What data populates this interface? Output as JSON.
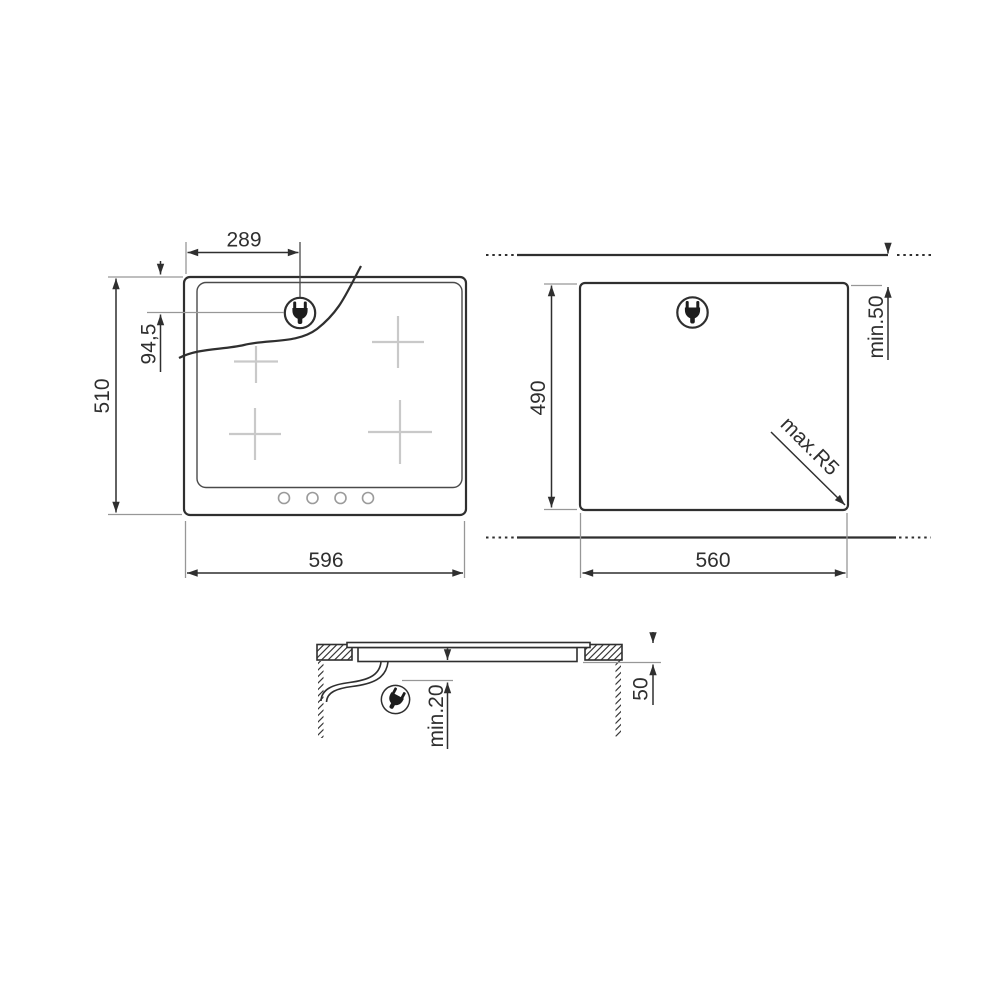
{
  "page": {
    "background": "#ffffff"
  },
  "drawing": {
    "title": "hob-installation-diagram",
    "colors": {
      "line": "#2f2f2f",
      "extension_line": "#979797",
      "zone_marker": "#c9c9c9",
      "control_dot": "#9b9b9b"
    },
    "front_view": {
      "width_label": "596",
      "height_label": "510",
      "plug_offset_x_label": "289",
      "plug_offset_y_label": "94,5",
      "zone_count": 4,
      "control_count": 4
    },
    "cutout_view": {
      "width_label": "560",
      "height_label": "490",
      "rear_clearance_label": "min.50",
      "corner_radius_label": "max.R5"
    },
    "section_view": {
      "below_clearance_label": "min.20",
      "worktop_thickness_label": "50"
    },
    "icons": {
      "plug": "power-plug-icon"
    }
  }
}
